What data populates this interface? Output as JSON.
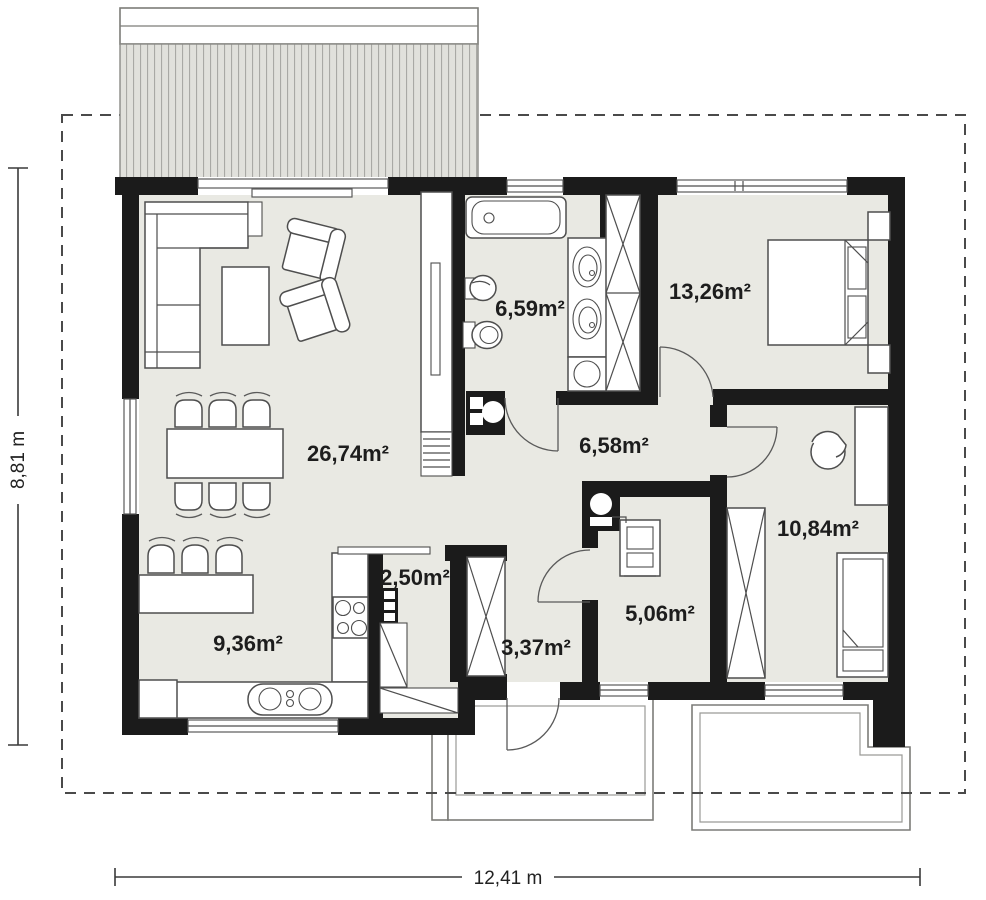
{
  "plan": {
    "rooms": {
      "living": "26,74m²",
      "bathroom": "6,59m²",
      "bedroom_main": "13,26m²",
      "hall": "6,58m²",
      "bedroom_child": "10,84m²",
      "pantry": "2,50m²",
      "entry": "3,37m²",
      "utility": "5,06m²",
      "kitchen": "9,36m²"
    },
    "dimensions": {
      "height": "8,81 m",
      "width": "12,41 m"
    },
    "colors": {
      "wall": "#1b1b1b",
      "floor": "#e9e9e3",
      "terrace_hatch_fill": "#e1e1dc",
      "terrace_hatch_line": "#a9a9a5",
      "furniture_stroke": "#4e4e4e",
      "dashed_boundary": "#4a4a4a"
    }
  }
}
